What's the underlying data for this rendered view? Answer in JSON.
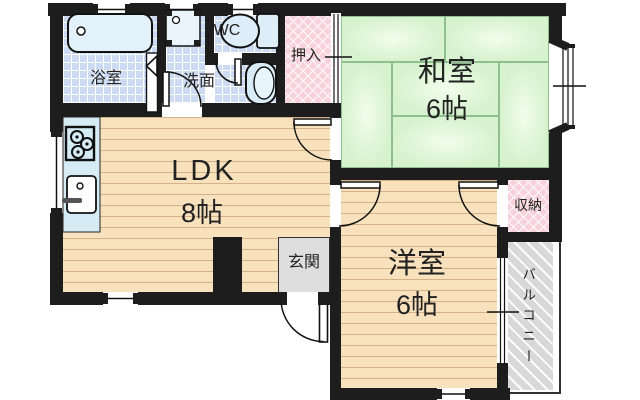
{
  "floorplan": {
    "title": "apartment-floorplan",
    "rooms": {
      "washitsu": {
        "label": "和室",
        "size": "6帖"
      },
      "ldk": {
        "label": "LDK",
        "size": "8帖"
      },
      "youshitsu": {
        "label": "洋室",
        "size": "6帖"
      },
      "bathroom": {
        "label": "浴室"
      },
      "washroom": {
        "label": "洗面"
      },
      "wc": {
        "label": "WC"
      },
      "oshiire": {
        "label": "押入"
      },
      "genkan": {
        "label": "玄関"
      },
      "storage": {
        "label": "収納"
      },
      "balcony": {
        "label": "バルコニー"
      }
    },
    "colors": {
      "wall": "#1d1d1d",
      "tatami_green": "#d9f3d1",
      "wood_floor": "#f7e2bd",
      "tile_blue": "#ccdbf1",
      "closet_pink": "#f8d2da",
      "entry_gray": "#dedede",
      "balcony_gray": "#d8d8d8"
    }
  }
}
